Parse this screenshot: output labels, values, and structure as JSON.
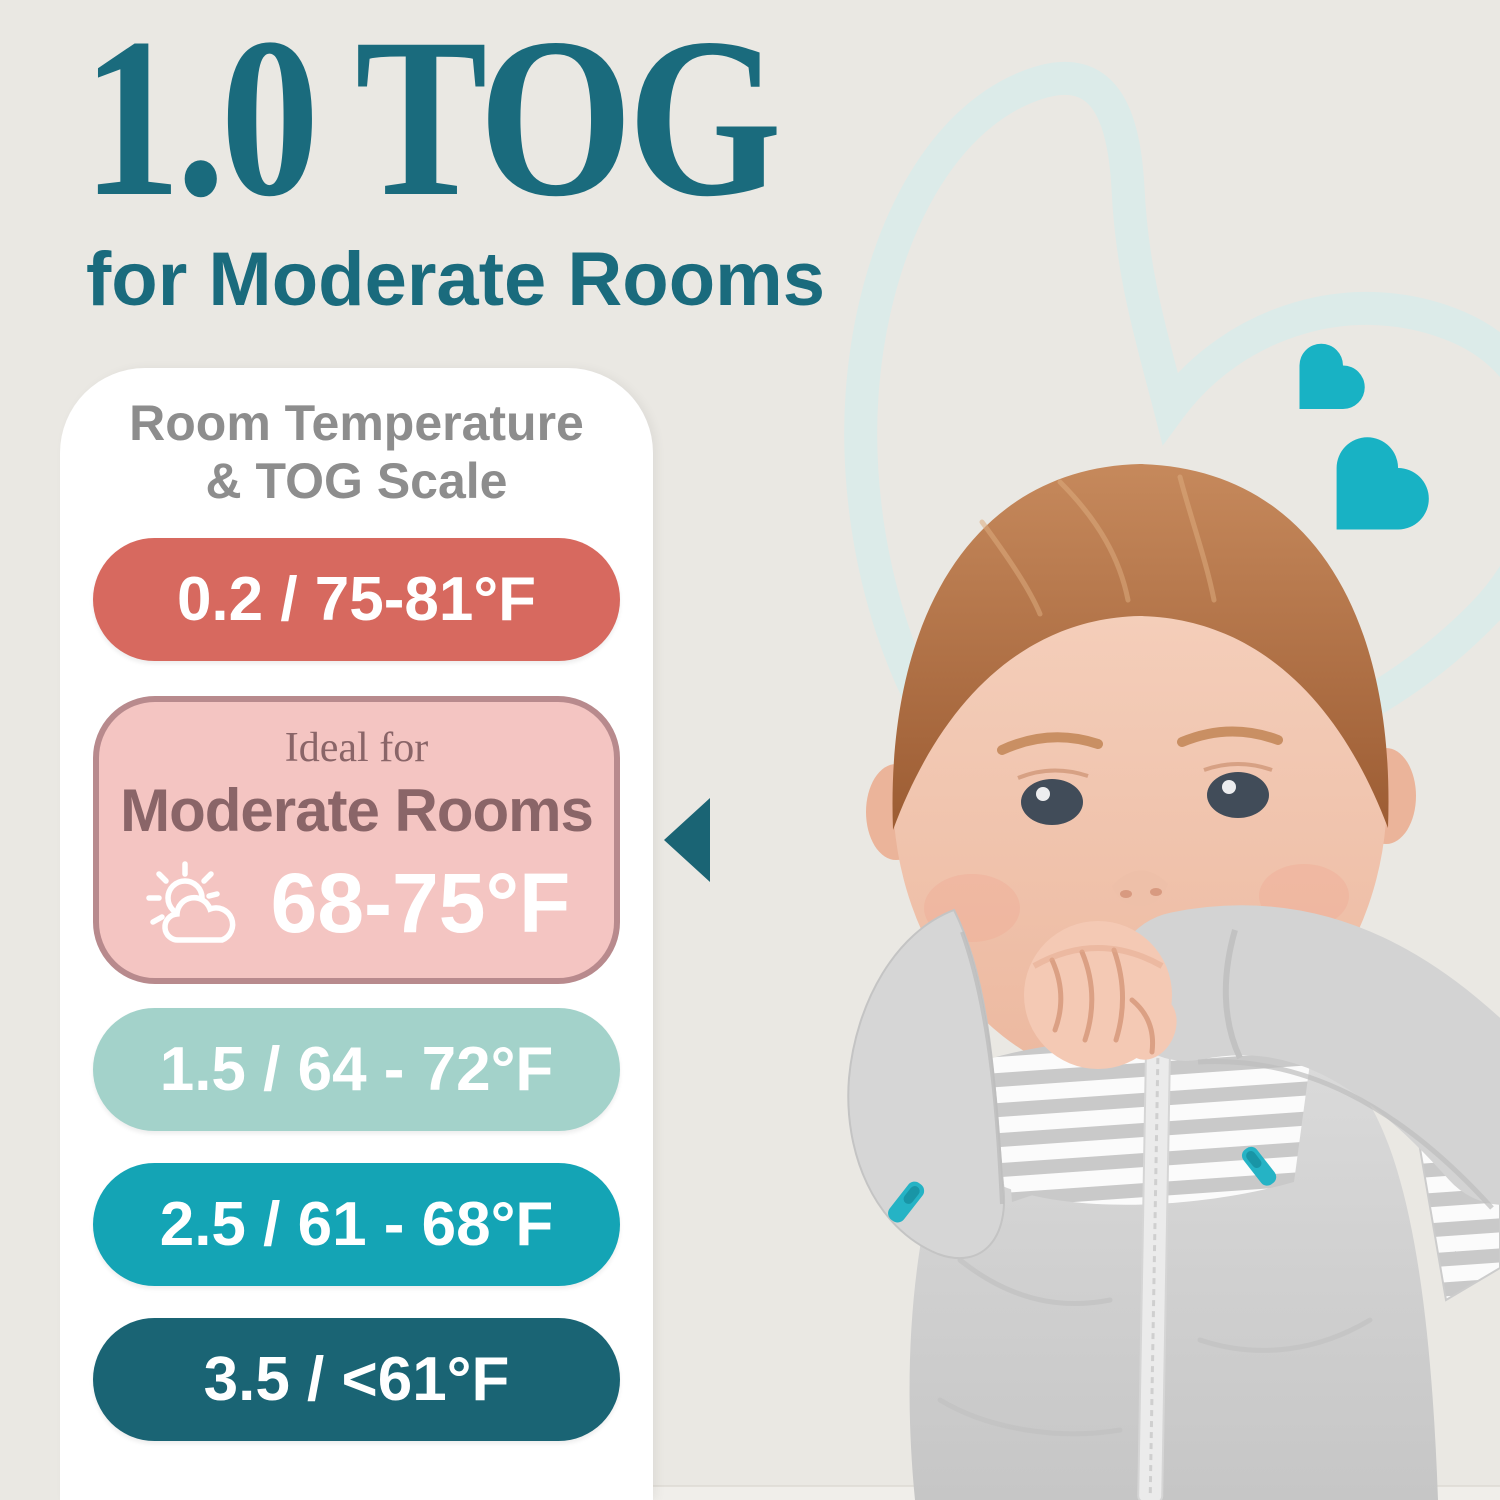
{
  "header": {
    "title": "1.0 TOG",
    "subtitle": "for Moderate Rooms"
  },
  "tog_card": {
    "heading_line1": "Room Temperature",
    "heading_line2": "& TOG Scale",
    "pills": [
      {
        "label": "0.2 / 75-81°F"
      },
      {
        "label": "1.5 / 64 - 72°F"
      },
      {
        "label": "2.5 / 61 - 68°F"
      },
      {
        "label": "3.5 / <61°F"
      }
    ],
    "ideal": {
      "eyebrow": "Ideal for",
      "room_type": "Moderate Rooms",
      "temp_range": "68-75°F",
      "weather_icon": "sun-behind-cloud-icon"
    }
  },
  "chart_data": {
    "type": "table",
    "title": "Room Temperature & TOG Scale",
    "columns": [
      "TOG",
      "Room Temperature (°F)"
    ],
    "rows": [
      [
        "0.2",
        "75-81°F"
      ],
      [
        "1.0",
        "68-75°F (Ideal for Moderate Rooms)"
      ],
      [
        "1.5",
        "64-72°F"
      ],
      [
        "2.5",
        "61-68°F"
      ],
      [
        "3.5",
        "<61°F"
      ]
    ]
  },
  "photo": {
    "description": "Smiling baby with hand in mouth wearing a gray arms-up swaddle with striped chest panel, center zipper and teal zipper pulls"
  },
  "colors": {
    "background": "#eae8e3",
    "title_teal": "#1a6b7d",
    "card_white": "#ffffff",
    "heading_gray": "#8d8d8d",
    "pill_02": "#d7695f",
    "pill_15": "#a3d2ca",
    "pill_25": "#14a4b5",
    "pill_35": "#1a6474",
    "ideal_bg": "#f4c5c2",
    "ideal_border": "#b88a8d",
    "ideal_text": "#8a6568",
    "accent_hearts": "#18b2c4",
    "heart_outline": "#dcebe9"
  }
}
